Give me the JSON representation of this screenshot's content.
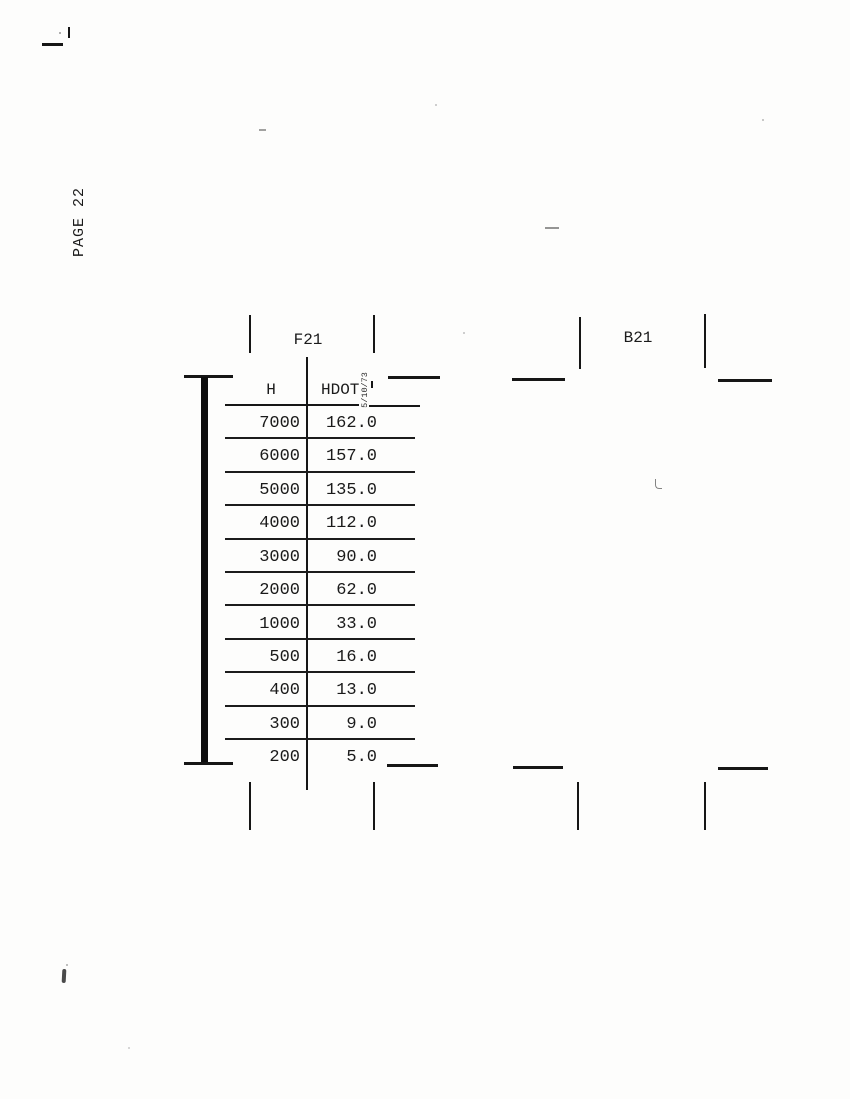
{
  "page": {
    "number_label": "PAGE 22"
  },
  "frames": {
    "f21_label": "F21",
    "b21_label": "B21"
  },
  "table": {
    "column_h": "H",
    "column_hdot": "HDOT",
    "date_note": "5/10/73",
    "rows": [
      {
        "h": "7000",
        "hdot": "162.0"
      },
      {
        "h": "6000",
        "hdot": "157.0"
      },
      {
        "h": "5000",
        "hdot": "135.0"
      },
      {
        "h": "4000",
        "hdot": "112.0"
      },
      {
        "h": "3000",
        "hdot": "90.0"
      },
      {
        "h": "2000",
        "hdot": "62.0"
      },
      {
        "h": "1000",
        "hdot": "33.0"
      },
      {
        "h": "500",
        "hdot": "16.0"
      },
      {
        "h": "400",
        "hdot": "13.0"
      },
      {
        "h": "300",
        "hdot": "9.0"
      },
      {
        "h": "200",
        "hdot": "5.0"
      }
    ]
  },
  "colors": {
    "ink": "#1a1a1a",
    "paper": "#fdfdfc"
  }
}
